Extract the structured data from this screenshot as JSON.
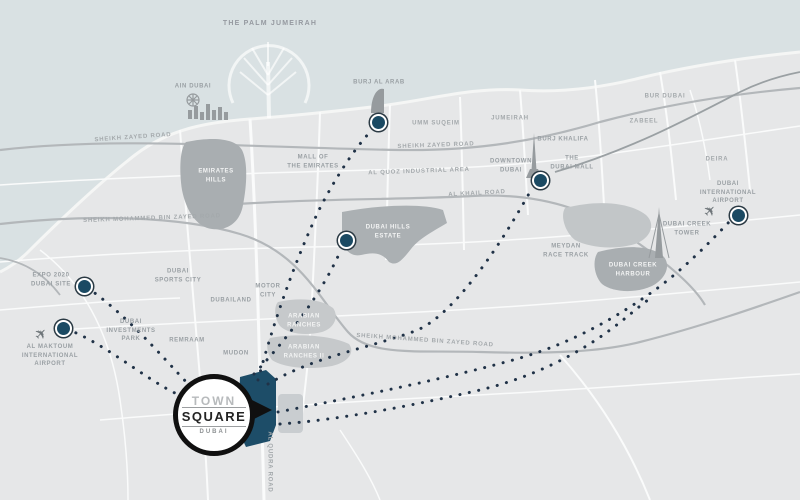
{
  "map": {
    "title": "Town Square Dubai location map",
    "colors": {
      "sea": "#d9e1e3",
      "land": "#e6e7e8",
      "district_gray": "#a9aeb1",
      "district_light": "#c6c9cb",
      "road_white": "#fafbfb",
      "highway_gray": "#b3b7ba",
      "marker_fill": "#1b4a63",
      "dotted_line": "#203247",
      "site_teal": "#1d4d68",
      "label_gray": "#9aa0a4",
      "label_white": "#f3f4f4"
    },
    "logo": {
      "line1": "TOWN",
      "line2": "SQUARE",
      "line3": "DUBAI"
    },
    "labels": [
      {
        "id": "the-palm-jumeirah",
        "text": "THE PALM JUMEIRAH",
        "x": 270,
        "y": 24,
        "cls": "big",
        "rot": 0
      },
      {
        "id": "ain-dubai",
        "text": "AIN DUBAI",
        "x": 193,
        "y": 87,
        "cls": "",
        "rot": 0
      },
      {
        "id": "burj-al-arab",
        "text": "BURJ AL ARAB",
        "x": 379,
        "y": 83,
        "cls": "",
        "rot": 0
      },
      {
        "id": "umm-suqeim",
        "text": "UMM SUQEIM",
        "x": 436,
        "y": 124,
        "cls": "road",
        "rot": 0
      },
      {
        "id": "jumeirah",
        "text": "JUMEIRAH",
        "x": 510,
        "y": 119,
        "cls": "road",
        "rot": 0
      },
      {
        "id": "bur-dubai",
        "text": "BUR DUBAI",
        "x": 665,
        "y": 97,
        "cls": "road",
        "rot": 0
      },
      {
        "id": "zabeel",
        "text": "ZABEEL",
        "x": 644,
        "y": 122,
        "cls": "road",
        "rot": 0
      },
      {
        "id": "deira",
        "text": "DEIRA",
        "x": 717,
        "y": 160,
        "cls": "road",
        "rot": 0
      },
      {
        "id": "sheikh-zayed-road-west",
        "text": "SHEIKH ZAYED ROAD",
        "x": 133,
        "y": 138,
        "cls": "road",
        "rot": -4
      },
      {
        "id": "sheikh-zayed-road-east",
        "text": "SHEIKH ZAYED ROAD",
        "x": 436,
        "y": 146,
        "cls": "road",
        "rot": -2
      },
      {
        "id": "mall-of-the-emirates",
        "text": "MALL OF\nTHE EMIRATES",
        "x": 313,
        "y": 162,
        "cls": "",
        "rot": 0
      },
      {
        "id": "al-quoz",
        "text": "AL QUOZ INDUSTRIAL AREA",
        "x": 419,
        "y": 172,
        "cls": "road",
        "rot": -2
      },
      {
        "id": "burj-khalifa",
        "text": "BURJ KHALIFA",
        "x": 563,
        "y": 140,
        "cls": "",
        "rot": 0
      },
      {
        "id": "downtown-dubai",
        "text": "DOWNTOWN\nDUBAI",
        "x": 511,
        "y": 166,
        "cls": "",
        "rot": 0
      },
      {
        "id": "the-dubai-mall",
        "text": "THE\nDUBAI MALL",
        "x": 572,
        "y": 163,
        "cls": "",
        "rot": 0
      },
      {
        "id": "al-khail-road",
        "text": "AL KHAIL ROAD",
        "x": 477,
        "y": 194,
        "cls": "road",
        "rot": -3
      },
      {
        "id": "smbz-road-west",
        "text": "SHEIKH MOHAMMED BIN ZAYED ROAD",
        "x": 152,
        "y": 219,
        "cls": "road",
        "rot": -2
      },
      {
        "id": "smbz-road-east",
        "text": "SHEIKH MOHAMMED BIN ZAYED ROAD",
        "x": 425,
        "y": 341,
        "cls": "road",
        "rot": 4
      },
      {
        "id": "emirates-hills",
        "text": "EMIRATES\nHILLS",
        "x": 216,
        "y": 176,
        "cls": "white",
        "rot": 0
      },
      {
        "id": "dubai-hills-estate",
        "text": "DUBAI HILLS\nESTATE",
        "x": 388,
        "y": 232,
        "cls": "white",
        "rot": 0
      },
      {
        "id": "meydan-race-track",
        "text": "MEYDAN\nRACE TRACK",
        "x": 566,
        "y": 251,
        "cls": "",
        "rot": 0
      },
      {
        "id": "dubai-creek-tower",
        "text": "DUBAI CREEK\nTOWER",
        "x": 687,
        "y": 229,
        "cls": "",
        "rot": 0
      },
      {
        "id": "dubai-creek-harbour",
        "text": "DUBAI CREEK\nHARBOUR",
        "x": 633,
        "y": 270,
        "cls": "white",
        "rot": 0
      },
      {
        "id": "dubai-intl-airport",
        "text": "DUBAI\nINTERNATIONAL\nAIRPORT",
        "x": 728,
        "y": 193,
        "cls": "",
        "rot": 0
      },
      {
        "id": "dubai-sports-city",
        "text": "DUBAI\nSPORTS CITY",
        "x": 178,
        "y": 276,
        "cls": "",
        "rot": 0
      },
      {
        "id": "motor-city",
        "text": "MOTOR\nCITY",
        "x": 268,
        "y": 291,
        "cls": "",
        "rot": 0
      },
      {
        "id": "dubailand",
        "text": "DUBAILAND",
        "x": 231,
        "y": 301,
        "cls": "",
        "rot": 0
      },
      {
        "id": "arabian-ranches",
        "text": "ARABIAN\nRANCHES",
        "x": 304,
        "y": 321,
        "cls": "white",
        "rot": 0
      },
      {
        "id": "arabian-ranches-2",
        "text": "ARABIAN\nRANCHES II",
        "x": 304,
        "y": 352,
        "cls": "white",
        "rot": 0
      },
      {
        "id": "dubai-investments-park",
        "text": "DUBAI\nINVESTMENTS\nPARK",
        "x": 131,
        "y": 331,
        "cls": "",
        "rot": 0
      },
      {
        "id": "remraam",
        "text": "REMRAAM",
        "x": 187,
        "y": 341,
        "cls": "",
        "rot": 0
      },
      {
        "id": "mudon",
        "text": "MUDON",
        "x": 236,
        "y": 354,
        "cls": "",
        "rot": 0
      },
      {
        "id": "expo-2020",
        "text": "EXPO 2020\nDUBAI SITE",
        "x": 51,
        "y": 280,
        "cls": "",
        "rot": 0
      },
      {
        "id": "al-maktoum-airport",
        "text": "AL MAKTOUM\nINTERNATIONAL\nAIRPORT",
        "x": 50,
        "y": 356,
        "cls": "",
        "rot": 0
      },
      {
        "id": "al-qudra-road",
        "text": "AL QUDRA ROAD",
        "x": 269,
        "y": 462,
        "cls": "road",
        "rot": 90
      }
    ],
    "markers": [
      {
        "id": "burj-al-arab",
        "x": 376,
        "y": 120
      },
      {
        "id": "downtown-dubai-mall",
        "x": 538,
        "y": 178
      },
      {
        "id": "dubai-hills-estate",
        "x": 344,
        "y": 238
      },
      {
        "id": "dubai-international-airport",
        "x": 736,
        "y": 213
      },
      {
        "id": "expo-2020-site",
        "x": 82,
        "y": 284
      },
      {
        "id": "al-maktoum-airport",
        "x": 61,
        "y": 326
      }
    ],
    "planes": [
      {
        "id": "al-maktoum-plane",
        "x": 41,
        "y": 334
      },
      {
        "id": "dxb-plane",
        "x": 710,
        "y": 211
      }
    ]
  }
}
